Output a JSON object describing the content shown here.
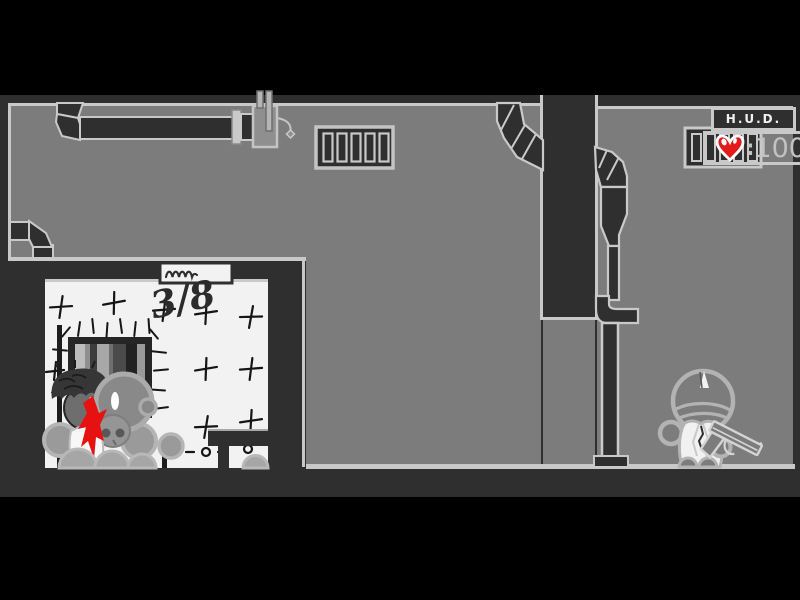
{
  "stage": {
    "width": 800,
    "height": 600,
    "description": "flash-shooter-game-scene"
  },
  "hud": {
    "title": "H.U.D.",
    "health_separator": ":",
    "health_value": "100",
    "heart_icon": "heart-icon"
  },
  "graffiti": {
    "wall_count": "3/8"
  },
  "icons": {
    "door_sign": "scribble-sign-icon",
    "health": "heart-icon"
  },
  "colors": {
    "background": "#000000",
    "structure_dark": "#2f2f2f",
    "room_gray": "#7c7c7c",
    "outline_light": "#c9c9c9",
    "cell_white": "#f2f2f2",
    "blood_red": "#e61212",
    "heart_red": "#e31b1b",
    "hud_title_text": "#f0f0f0",
    "health_text": "#c2c2c2"
  }
}
